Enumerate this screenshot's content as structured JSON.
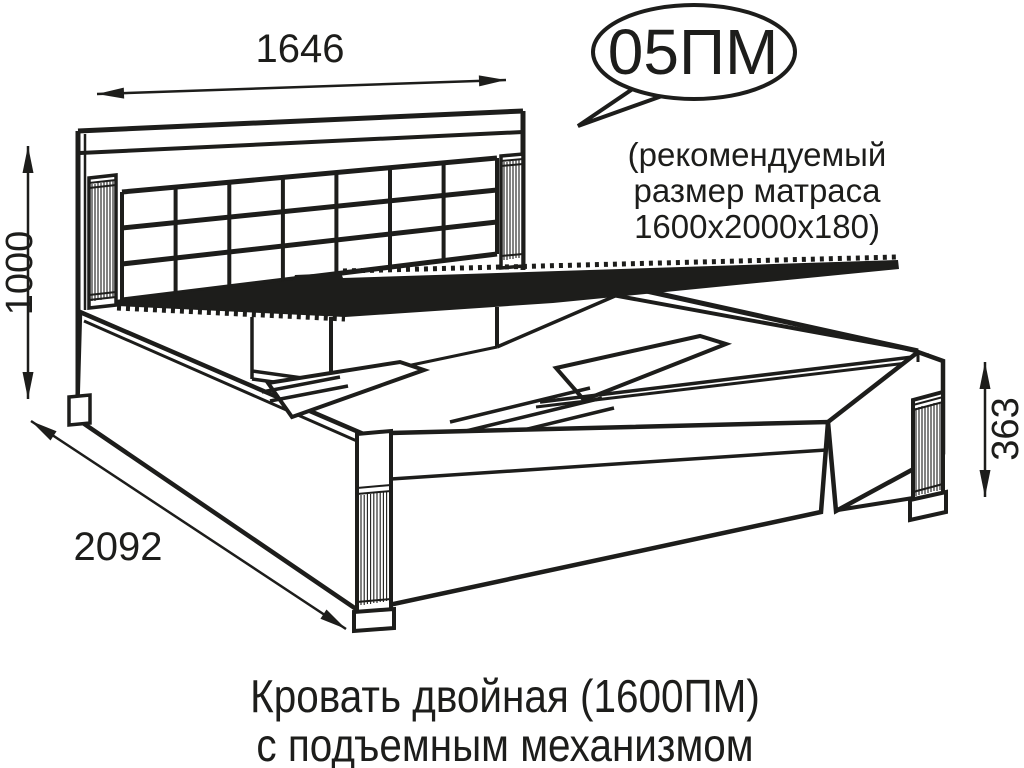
{
  "callout": {
    "model_label": "05ПМ"
  },
  "mattress_note": {
    "lines": [
      "(рекомендуемый",
      "размер матраса",
      "1600х2000х180)"
    ]
  },
  "dimensions": {
    "headboard_width": "1646",
    "headboard_height": "1000",
    "bed_length": "2092",
    "base_height": "363"
  },
  "caption": {
    "line1": "Кровать двойная (1600ПМ)",
    "line2": "с подъемным механизмом"
  },
  "colors": {
    "line": "#1d1d1b",
    "background": "#ffffff"
  }
}
